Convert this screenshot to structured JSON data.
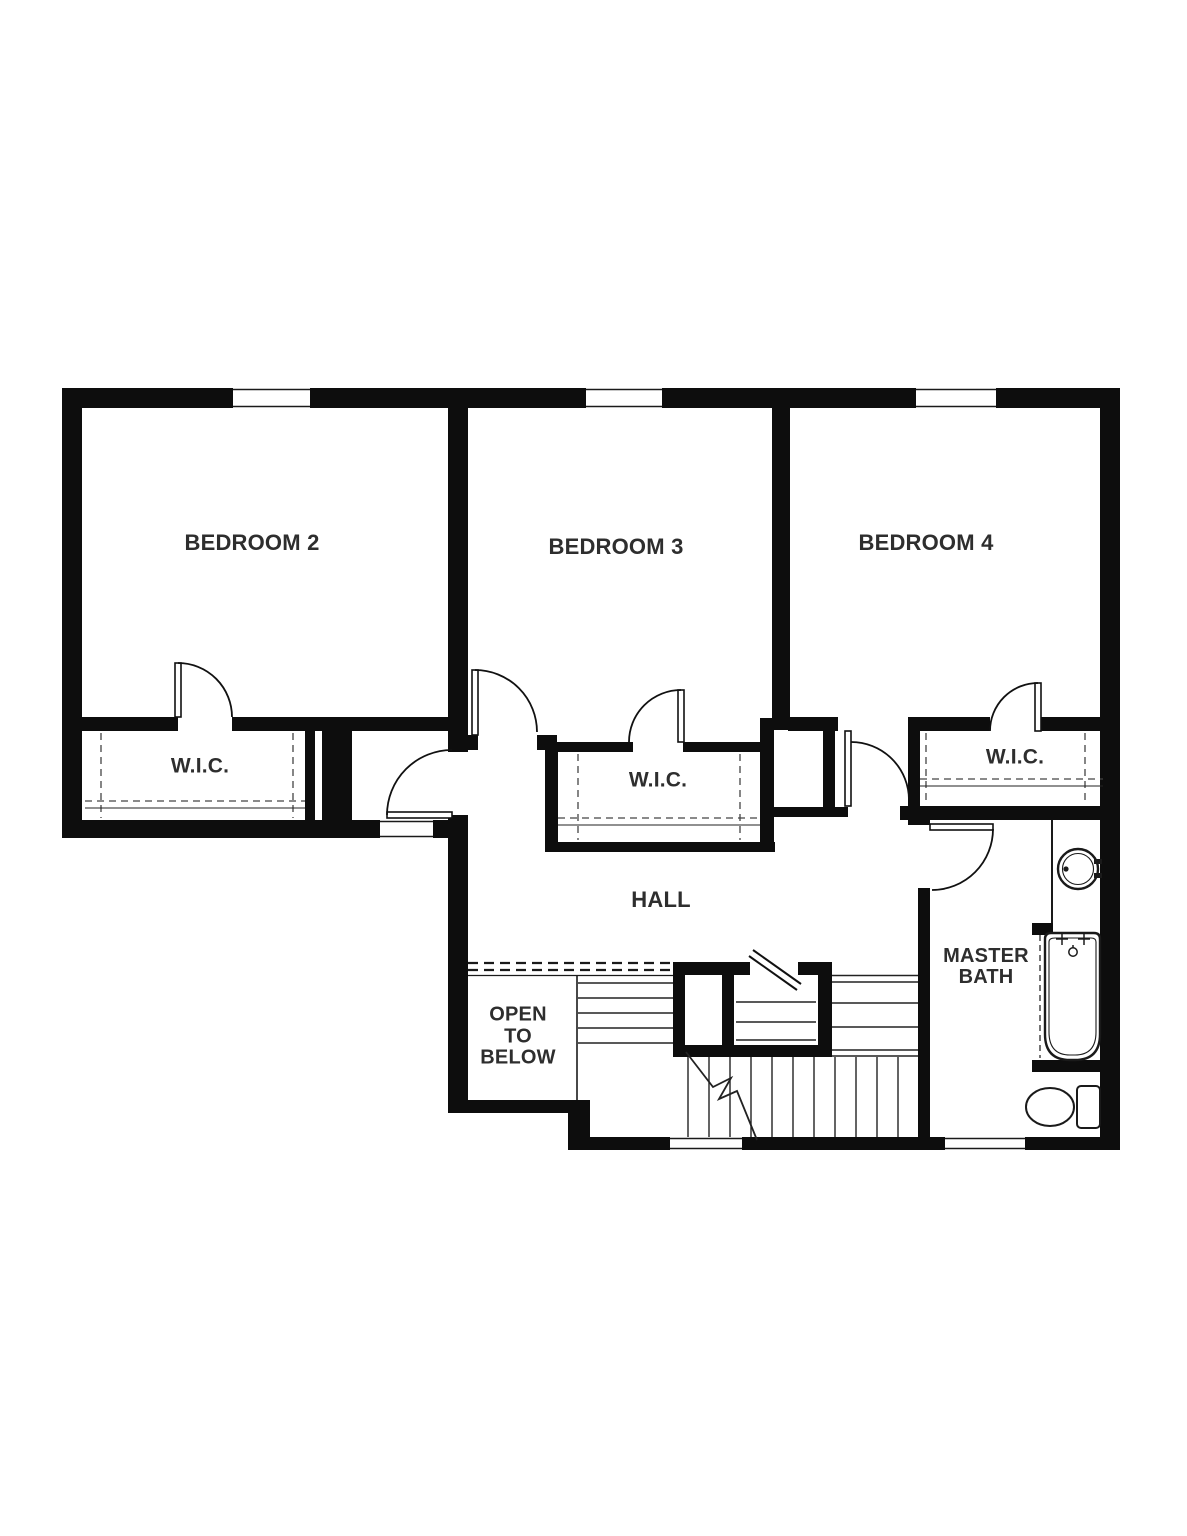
{
  "plan": {
    "rooms": {
      "bedroom2": {
        "label": "BEDROOM 2"
      },
      "bedroom3": {
        "label": "BEDROOM 3"
      },
      "bedroom4": {
        "label": "BEDROOM 4"
      },
      "wic2": {
        "label": "W.I.C."
      },
      "wic3": {
        "label": "W.I.C."
      },
      "wic4": {
        "label": "W.I.C."
      },
      "hall": {
        "label": "HALL"
      },
      "open_to_below": {
        "label": "OPEN\nTO\nBELOW"
      },
      "master_bath": {
        "label": "MASTER\nBATH"
      }
    },
    "fixtures": {
      "sink": "sink-icon",
      "bathtub": "bathtub-icon",
      "toilet": "toilet-icon",
      "stairs": "stairs",
      "railing": "open-to-below-railing"
    },
    "colors": {
      "walls": "#0d0d0d",
      "text": "#2e2e2e",
      "background": "#ffffff"
    }
  }
}
